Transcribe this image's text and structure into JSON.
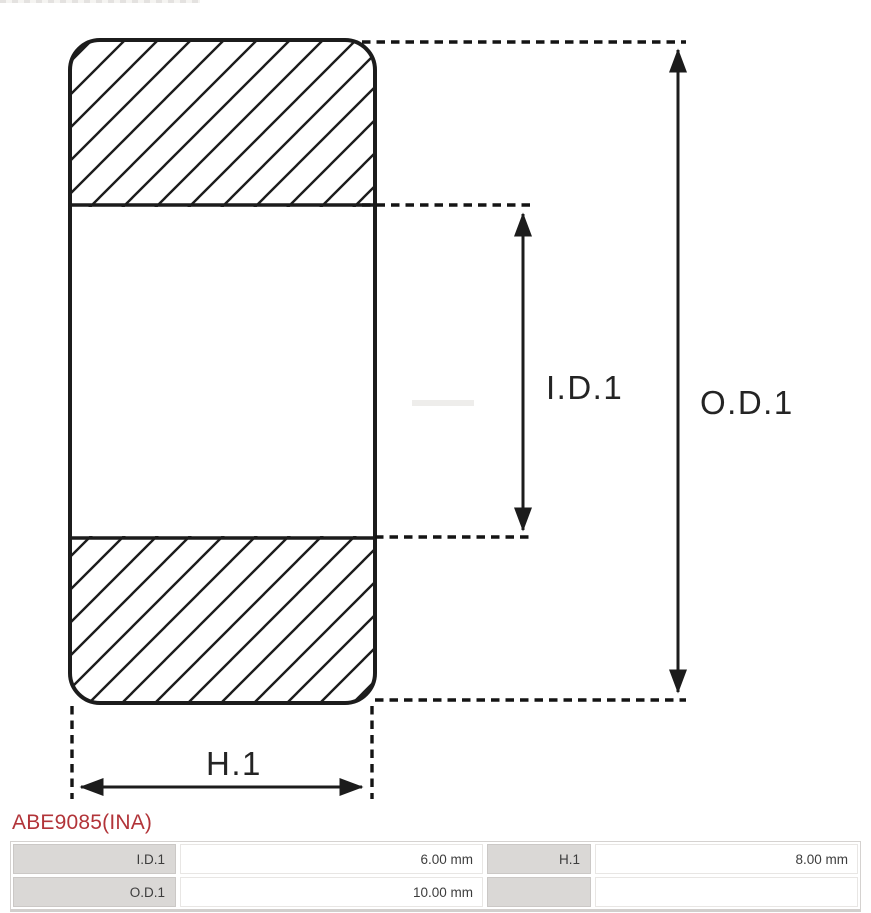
{
  "diagram": {
    "labels": {
      "inner_diameter": "I.D.1",
      "outer_diameter": "O.D.1",
      "height": "H.1"
    },
    "line_color": "#1c1c1c"
  },
  "part_number": {
    "text": "ABE9085(INA)",
    "color": "#b23439"
  },
  "spec_table": {
    "label_bg": "#dad8d6",
    "rows": [
      {
        "cells": [
          {
            "label": "I.D.1",
            "value": "6.00 mm"
          },
          {
            "label": "H.1",
            "value": "8.00 mm"
          }
        ]
      },
      {
        "cells": [
          {
            "label": "O.D.1",
            "value": "10.00 mm"
          },
          {
            "label": "",
            "value": ""
          }
        ]
      }
    ]
  }
}
